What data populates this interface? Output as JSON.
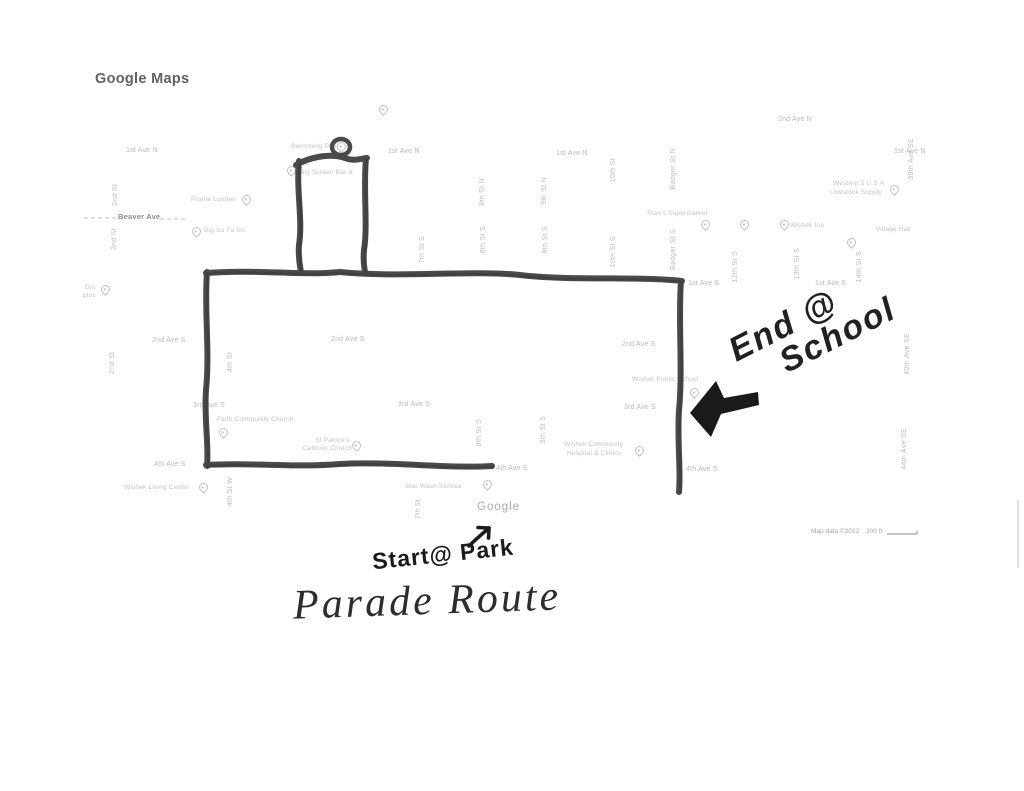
{
  "header": {
    "logo": "Google Maps"
  },
  "annotations": {
    "end_line1": "End @",
    "end_line2": "School",
    "start_label": "Start@ Park",
    "route_title": "Parade Route",
    "start_arrow_icon": "arrow-up-right",
    "end_arrow_icon": "arrow-left-down"
  },
  "map": {
    "streets_h": [
      "1st Ave N",
      "1st Ave N",
      "1st Ave N",
      "1st Ave N",
      "2nd Ave N",
      "Beaver Ave",
      "1st Ave S",
      "1st Ave S",
      "2nd Ave S",
      "2nd Ave S",
      "2nd Ave S",
      "3rd Ave S",
      "3rd Ave S",
      "3rd Ave S",
      "4th Ave S",
      "4th Ave S",
      "4th Ave S"
    ],
    "streets_v": [
      "2nd St",
      "2nd St",
      "2nd St",
      "4th St",
      "4th St W",
      "7th St S",
      "7th St",
      "8th St N",
      "8th St S",
      "8th St S",
      "9th St N",
      "9th St S",
      "5th St S",
      "10th St",
      "10th St S",
      "Badger St N",
      "Badger St S",
      "12th St S",
      "13th St S",
      "14th St S",
      "39th Ave SE",
      "40th Ave SE",
      "44th Ave SE"
    ],
    "places": [
      "Swimming Pool",
      "Big Screen Bar &",
      "Prairie Lumber",
      "Big Su Fa Inc",
      "Drs",
      "plus",
      "Stan's Supermarket",
      "Wishek Inn",
      "Village Hall",
      "Western 5 U.S.A",
      "Livestock Supply",
      "Faith Community Church",
      "St Patrick's",
      "Catholic Church",
      "Wishek Living Center",
      "Wishek Community",
      "Hospital & Clinics",
      "Wishek Public School",
      "Star Wash Service"
    ],
    "watermark": "Google",
    "map_data": "Map data ©2022",
    "scale_label": "200 ft"
  },
  "colors": {
    "route_stroke": "#4a4a4a",
    "arrow_fill": "#1a1a1a",
    "handwriting": "#1f1f1f",
    "map_label": "#b9b9b9",
    "logo_gray": "#616161"
  }
}
